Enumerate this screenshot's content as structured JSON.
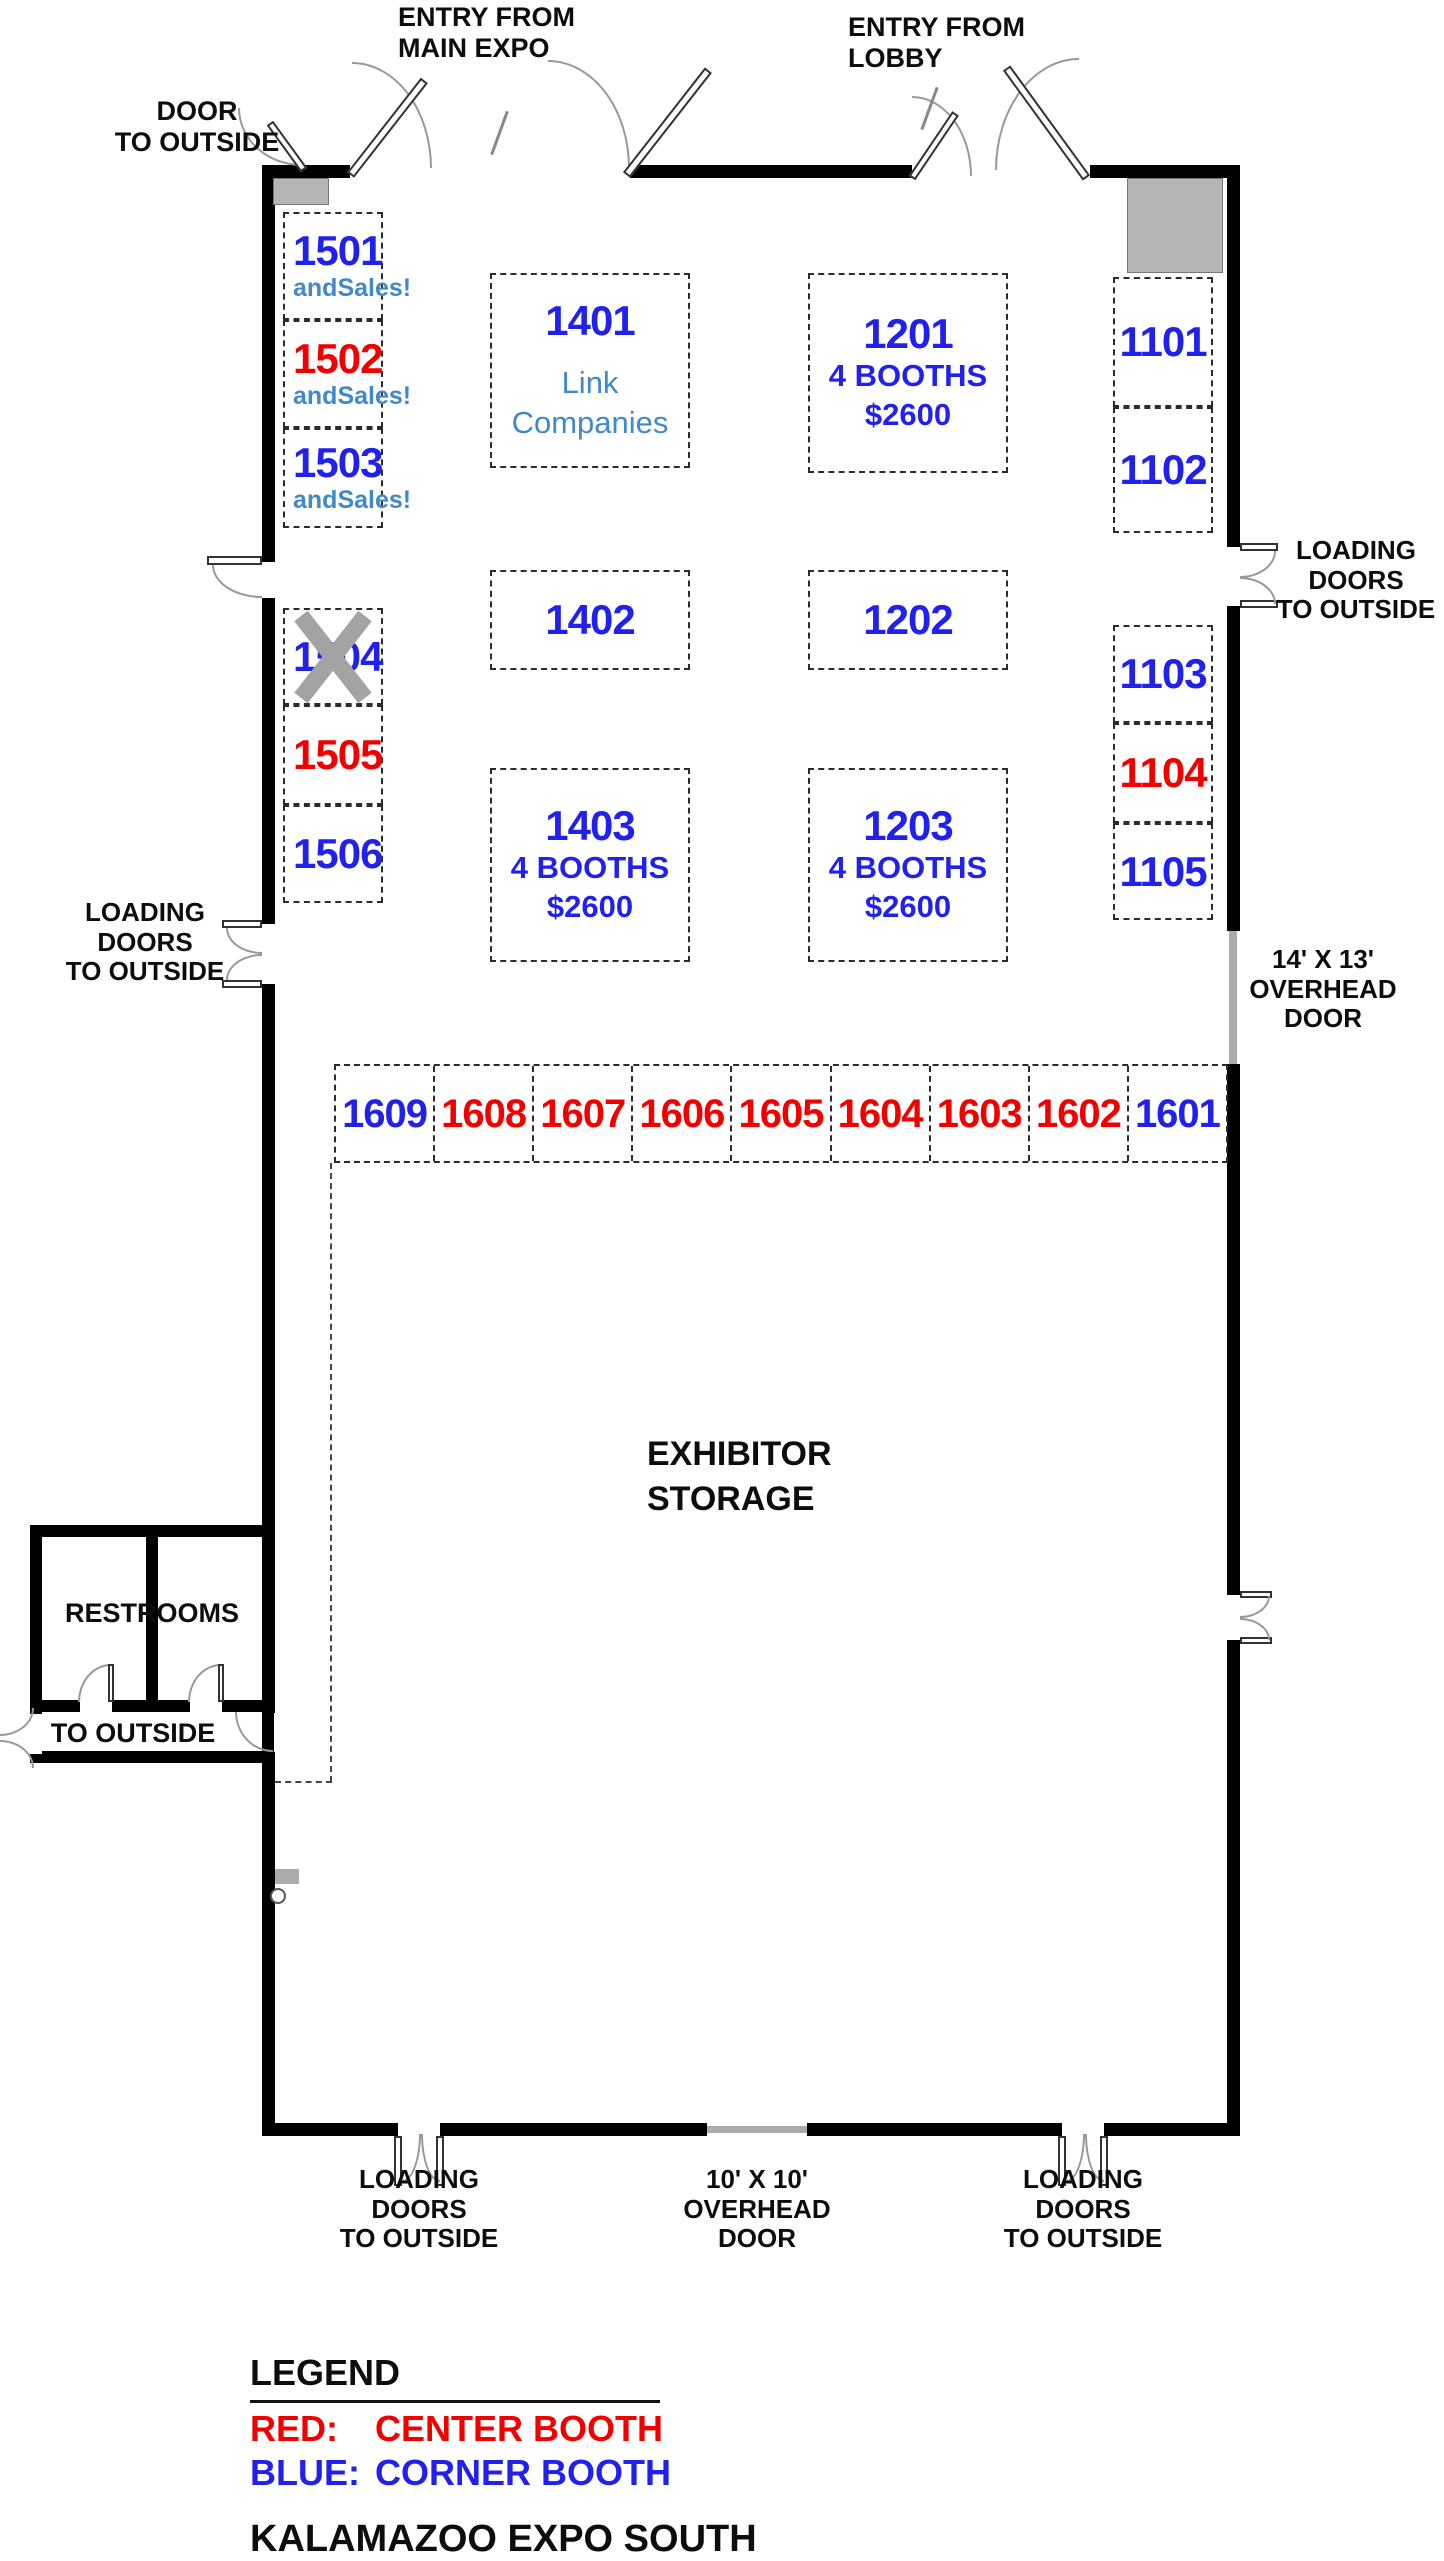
{
  "title": "KALAMAZOO EXPO SOUTH",
  "colors": {
    "corner_blue": "#2121EC",
    "center_red": "#F20000",
    "accent_blue": "#4189C7",
    "wall_black": "#000000",
    "gray_fill": "#B5B5B5",
    "x_gray": "#A3A3A3"
  },
  "labels": {
    "entry_main": [
      "ENTRY FROM",
      "MAIN EXPO"
    ],
    "entry_lobby": [
      "ENTRY FROM",
      "LOBBY"
    ],
    "door_outside": [
      "DOOR",
      "TO OUTSIDE"
    ],
    "loading_left": [
      "LOADING",
      "DOORS",
      "TO OUTSIDE"
    ],
    "loading_right": [
      "LOADING",
      "DOORS",
      "TO OUTSIDE"
    ],
    "overhead_right": [
      "14' X 13'",
      "OVERHEAD",
      "DOOR"
    ],
    "loading_bottom_left": [
      "LOADING",
      "DOORS",
      "TO OUTSIDE"
    ],
    "overhead_bottom": [
      "10' X 10'",
      "OVERHEAD",
      "DOOR"
    ],
    "loading_bottom_right": [
      "LOADING",
      "DOORS",
      "TO OUTSIDE"
    ],
    "exhibitor_storage": [
      "EXHIBITOR",
      "STORAGE"
    ],
    "restrooms": "RESTROOMS",
    "to_outside": "TO OUTSIDE"
  },
  "legend": {
    "heading": "LEGEND",
    "entries": [
      {
        "label": "RED:",
        "desc": "CENTER BOOTH",
        "color": "red"
      },
      {
        "label": "BLUE:",
        "desc": "CORNER BOOTH",
        "color": "blue"
      }
    ]
  },
  "booths": [
    {
      "num": "1501",
      "color": "blue",
      "sub": "andSales!",
      "x": 283,
      "y": 212,
      "w": 100,
      "h": 108,
      "align": "left"
    },
    {
      "num": "1502",
      "color": "red",
      "sub": "andSales!",
      "x": 283,
      "y": 320,
      "w": 100,
      "h": 108,
      "align": "left"
    },
    {
      "num": "1503",
      "color": "blue",
      "sub": "andSales!",
      "x": 283,
      "y": 428,
      "w": 100,
      "h": 100,
      "align": "left"
    },
    {
      "num": "1504",
      "color": "blue",
      "x": 283,
      "y": 608,
      "w": 100,
      "h": 97,
      "align": "left",
      "crossed": true
    },
    {
      "num": "1505",
      "color": "red",
      "x": 283,
      "y": 705,
      "w": 100,
      "h": 100,
      "align": "left"
    },
    {
      "num": "1506",
      "color": "blue",
      "x": 283,
      "y": 805,
      "w": 100,
      "h": 98,
      "align": "left"
    },
    {
      "num": "1401",
      "color": "blue",
      "x": 490,
      "y": 273,
      "w": 200,
      "h": 195,
      "sub2": [
        "Link",
        "Companies"
      ]
    },
    {
      "num": "1402",
      "color": "blue",
      "x": 490,
      "y": 570,
      "w": 200,
      "h": 100
    },
    {
      "num": "1403",
      "color": "blue",
      "x": 490,
      "y": 768,
      "w": 200,
      "h": 194,
      "lines": [
        "4 BOOTHS",
        "$2600"
      ]
    },
    {
      "num": "1201",
      "color": "blue",
      "x": 808,
      "y": 273,
      "w": 200,
      "h": 200,
      "lines": [
        "4 BOOTHS",
        "$2600"
      ]
    },
    {
      "num": "1202",
      "color": "blue",
      "x": 808,
      "y": 570,
      "w": 200,
      "h": 100
    },
    {
      "num": "1203",
      "color": "blue",
      "x": 808,
      "y": 768,
      "w": 200,
      "h": 194,
      "lines": [
        "4 BOOTHS",
        "$2600"
      ]
    },
    {
      "num": "1101",
      "color": "blue",
      "x": 1113,
      "y": 277,
      "w": 100,
      "h": 130
    },
    {
      "num": "1102",
      "color": "blue",
      "x": 1113,
      "y": 407,
      "w": 100,
      "h": 126
    },
    {
      "num": "1103",
      "color": "blue",
      "x": 1113,
      "y": 625,
      "w": 100,
      "h": 98
    },
    {
      "num": "1104",
      "color": "red",
      "x": 1113,
      "y": 723,
      "w": 100,
      "h": 100
    },
    {
      "num": "1105",
      "color": "blue",
      "x": 1113,
      "y": 823,
      "w": 100,
      "h": 97
    }
  ],
  "booth_row": {
    "x": 334,
    "y": 1064,
    "w": 894,
    "h": 99,
    "cells": [
      {
        "num": "1609",
        "color": "blue"
      },
      {
        "num": "1608",
        "color": "red"
      },
      {
        "num": "1607",
        "color": "red"
      },
      {
        "num": "1606",
        "color": "red"
      },
      {
        "num": "1605",
        "color": "red"
      },
      {
        "num": "1604",
        "color": "red"
      },
      {
        "num": "1603",
        "color": "red"
      },
      {
        "num": "1602",
        "color": "red"
      },
      {
        "num": "1601",
        "color": "blue"
      }
    ]
  }
}
